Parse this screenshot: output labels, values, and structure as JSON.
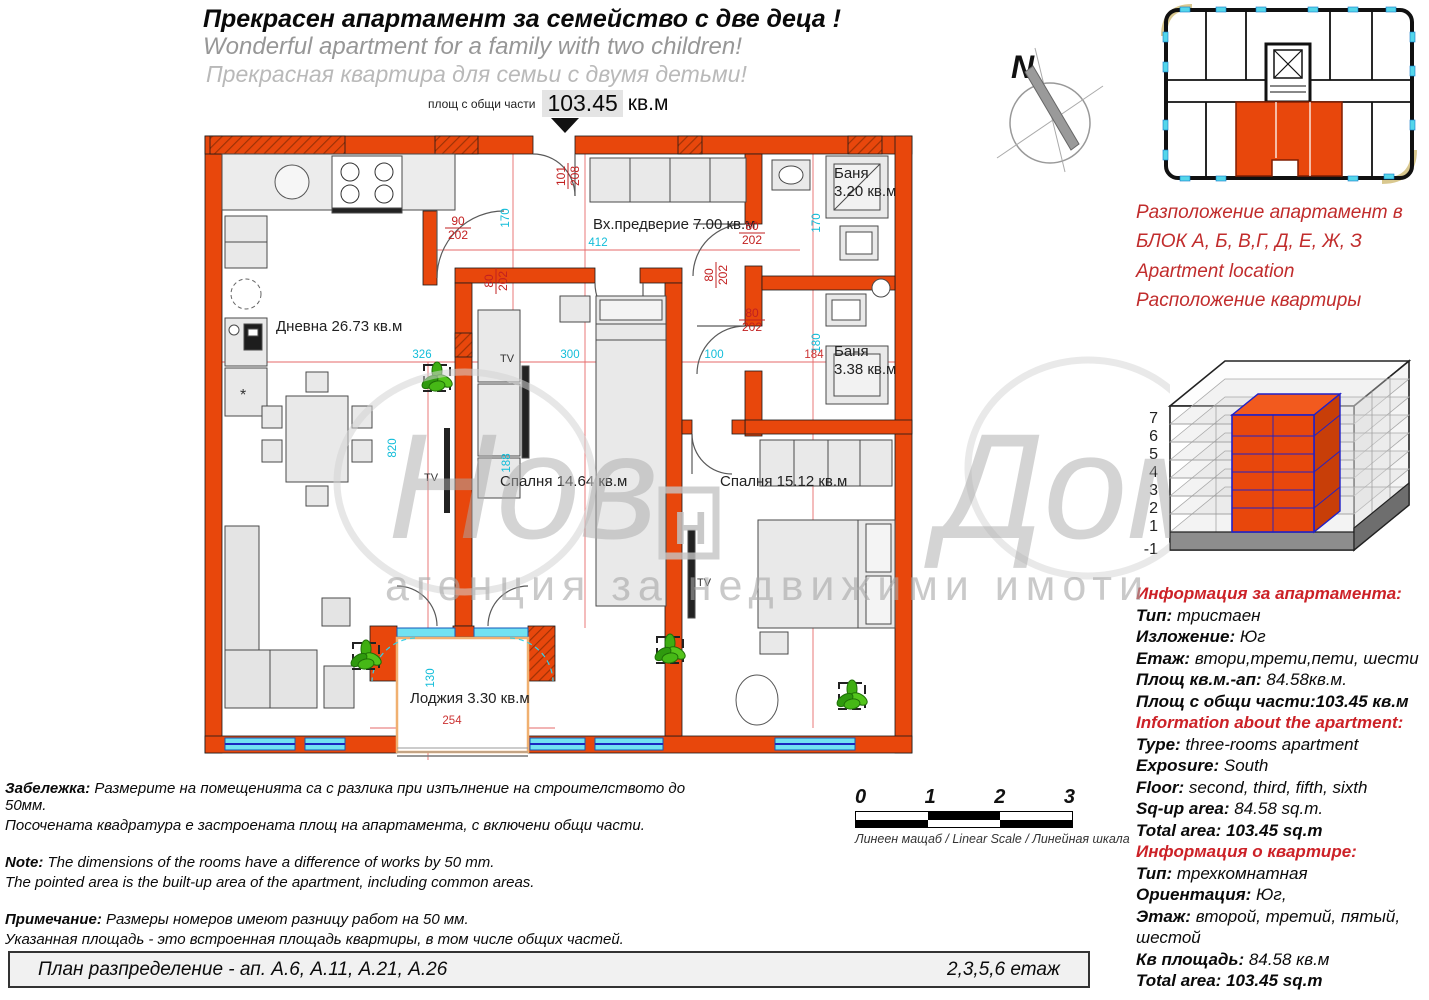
{
  "header": {
    "title_bg": "Прекрасен апартамент за семейство с две деца !",
    "title_en": "Wonderful apartment for a family with two children!",
    "title_ru": "Прекрасная квартира для семьи с двумя детьми!",
    "area_label": "площ с общи части",
    "area_value": "103.45",
    "area_unit": "кв.м"
  },
  "plan": {
    "living": "Дневна 26.73 кв.м",
    "hall": "Вх.предверие 7.00 кв.м",
    "bath1_name": "Баня",
    "bath1_area": "3.20 кв.м",
    "bath2_name": "Баня",
    "bath2_area": "3.38 кв.м",
    "bedroom1": "Спалня 14.64 кв.м",
    "bedroom2": "Спалня 15.12 кв.м",
    "loggia": "Лоджия  3.30 кв.м",
    "tv": "ТV",
    "fridge_mark": "*",
    "f101": {
      "num": "101",
      "den": "208"
    },
    "f90": {
      "num": "90",
      "den": "202"
    },
    "f80": {
      "num": "80",
      "den": "202"
    },
    "d170": "170",
    "d180": "180",
    "d820": "820",
    "d130": "130",
    "d188": "188",
    "d412": "412",
    "d326": "326",
    "d300": "300",
    "d100": "100",
    "d184": "184",
    "d254": "254"
  },
  "compass": {
    "north": "N"
  },
  "watermark": {
    "script_left": "Нов",
    "script_right": "Дом1",
    "logo_letter": "Н",
    "tagline": "агенция за недвижими имоти"
  },
  "location": {
    "line1": "Разположение апартамент в",
    "line2": "БЛОК  А, Б, В,Г, Д, Е, Ж, З",
    "line3": "Apartment location",
    "line4": "Расположение квартиры"
  },
  "iso": {
    "floors": [
      "7",
      "6",
      "5",
      "4",
      "3",
      "2",
      "1",
      "-1"
    ]
  },
  "info_bg": {
    "title": "Информация за апартамента:",
    "type_label": "Тип:",
    "type": " тристаен",
    "exposure_label": "Изложение:",
    "exposure": " Юг",
    "floor_label": "Етаж:",
    "floor": " втори,трети,пети, шести",
    "area_label": "Площ кв.м.-ап:",
    "area": " 84.58кв.м.",
    "total_label": "Площ с общи части:",
    "total": "103.45 кв.м"
  },
  "info_en": {
    "title": "Information about the apartment:",
    "type_label": "Type:",
    "type": " three-rooms apartment",
    "exposure_label": "Exposure:",
    "exposure": " South",
    "floor_label": "Floor:",
    "floor": " second, third, fifth, sixth",
    "area_label": "Sq-up area:",
    "area": " 84.58 sq.m.",
    "total_label": "Total area:",
    "total": " 103.45 sq.m"
  },
  "info_ru": {
    "title": "Информация о квартире:",
    "type_label": "Тип:",
    "type": " трехкомнатная",
    "exposure_label": "Ориентация:",
    "exposure": " Юг,",
    "floor_label": "Этаж:",
    "floor": " второй, третий, пятый, шестой",
    "area_label": "Кв площадь:",
    "area": " 84.58 кв.м",
    "total_label": "Total area:",
    "total": " 103.45 sq.m"
  },
  "notes": {
    "bg_label": "Забележка:",
    "bg1": " Размерите на помещенията са с разлика  при изпълнение на строителството до 50мм.",
    "bg2": "Посочената квадратура  е застроената площ на апартамента, с включени общи части.",
    "en_label": "Note:",
    "en1": " The dimensions of the rooms have a difference of works by 50 mm.",
    "en2": "The pointed area is the built-up area of the apartment, including common areas.",
    "ru_label": "Примечание:",
    "ru1": " Размеры номеров имеют разницу работ на 50 мм.",
    "ru2": "Указанная площадь - это встроенная площадь квартиры, в том числе общих частей."
  },
  "scalebar": {
    "t0": "0",
    "t1": "1",
    "t2": "2",
    "t3": "3",
    "caption": "Линеен мащаб / Linear Scale / Линейная шкала"
  },
  "footer": {
    "left": "План разпределение  - ап. А.6, А.11, А.21, А.26",
    "right": "2,3,5,6 етаж"
  },
  "colors": {
    "wall_orange": "#e8470c",
    "accent_red": "#cc2127",
    "dim_cyan": "#12bdd9",
    "window_cyan": "#72e2f2"
  }
}
